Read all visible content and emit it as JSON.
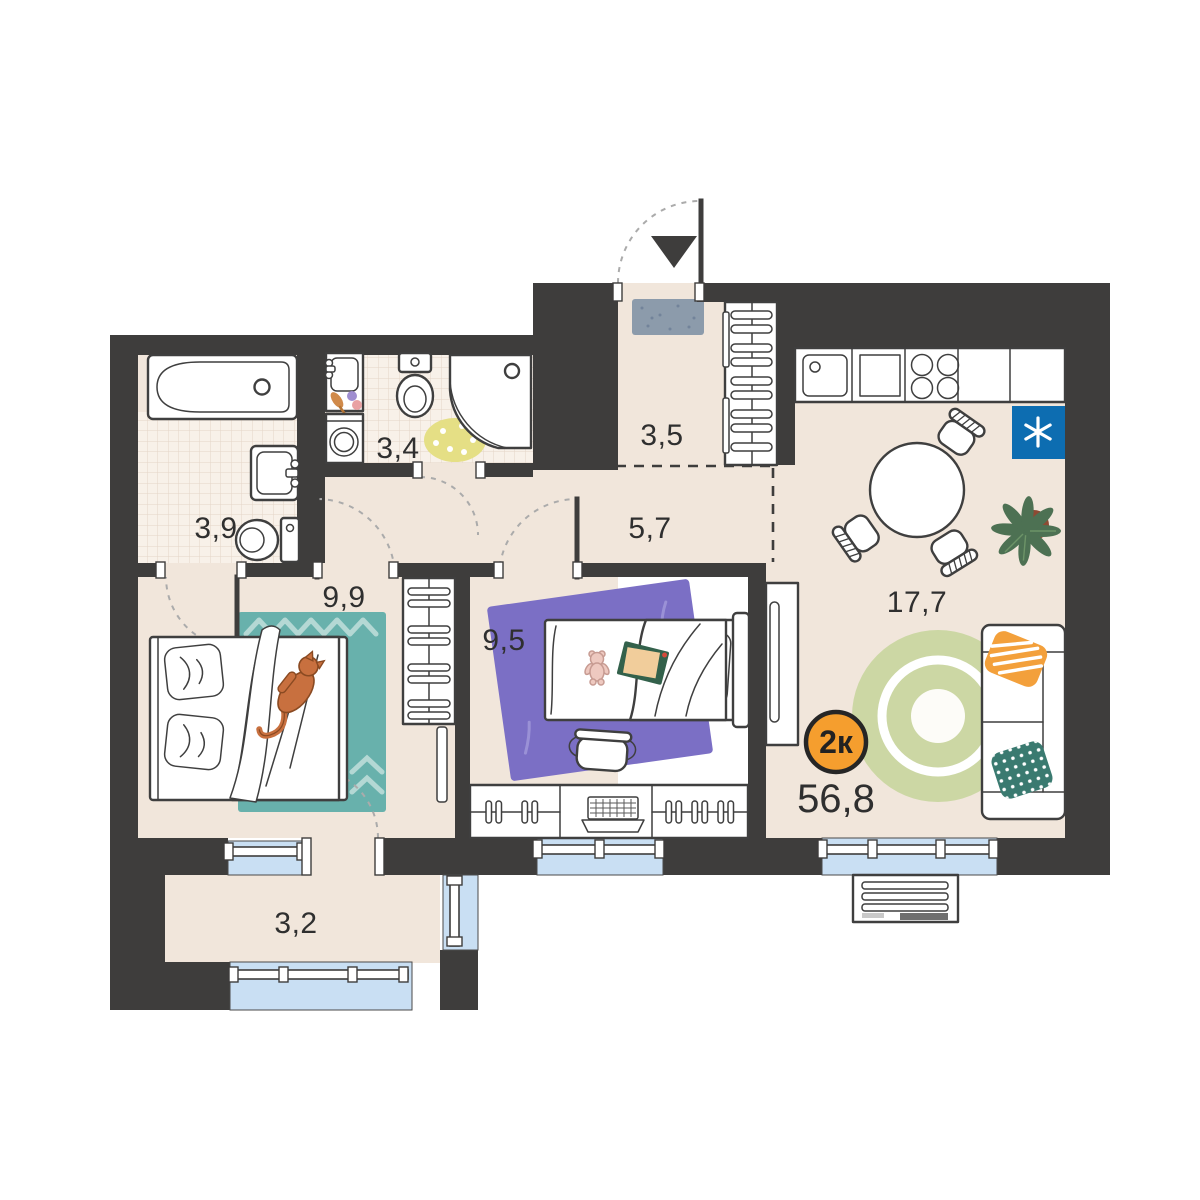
{
  "plan": {
    "type_badge": "2к",
    "total_area": "56,8",
    "rooms": [
      {
        "id": "bathroom",
        "area": "3,9"
      },
      {
        "id": "wc-laundry",
        "area": "3,4"
      },
      {
        "id": "hallway",
        "area": "3,5"
      },
      {
        "id": "corridor",
        "area": "5,7"
      },
      {
        "id": "bedroom",
        "area": "9,9"
      },
      {
        "id": "kids-room",
        "area": "9,5"
      },
      {
        "id": "kitchen-living",
        "area": "17,7"
      },
      {
        "id": "balcony",
        "area": "3,2"
      }
    ],
    "colors": {
      "wall": "#3e3d3c",
      "floor": "#f1e6db",
      "tile": "#f8f1e9",
      "window": "#c9dff3",
      "accent": "#f59e2e",
      "fridge": "#0d6db1",
      "rug_teal": "#68b1ac",
      "rug_purple": "#7b6fc5",
      "rug_green": "#ccd7a4",
      "rug_yellow": "#e5df85",
      "doormat": "#8c9bab",
      "pillow_orange": "#f3a03b",
      "pillow_teal": "#3a7a70",
      "cat": "#c8703f",
      "plant": "#4d7153",
      "pot": "#8d4a33"
    }
  }
}
